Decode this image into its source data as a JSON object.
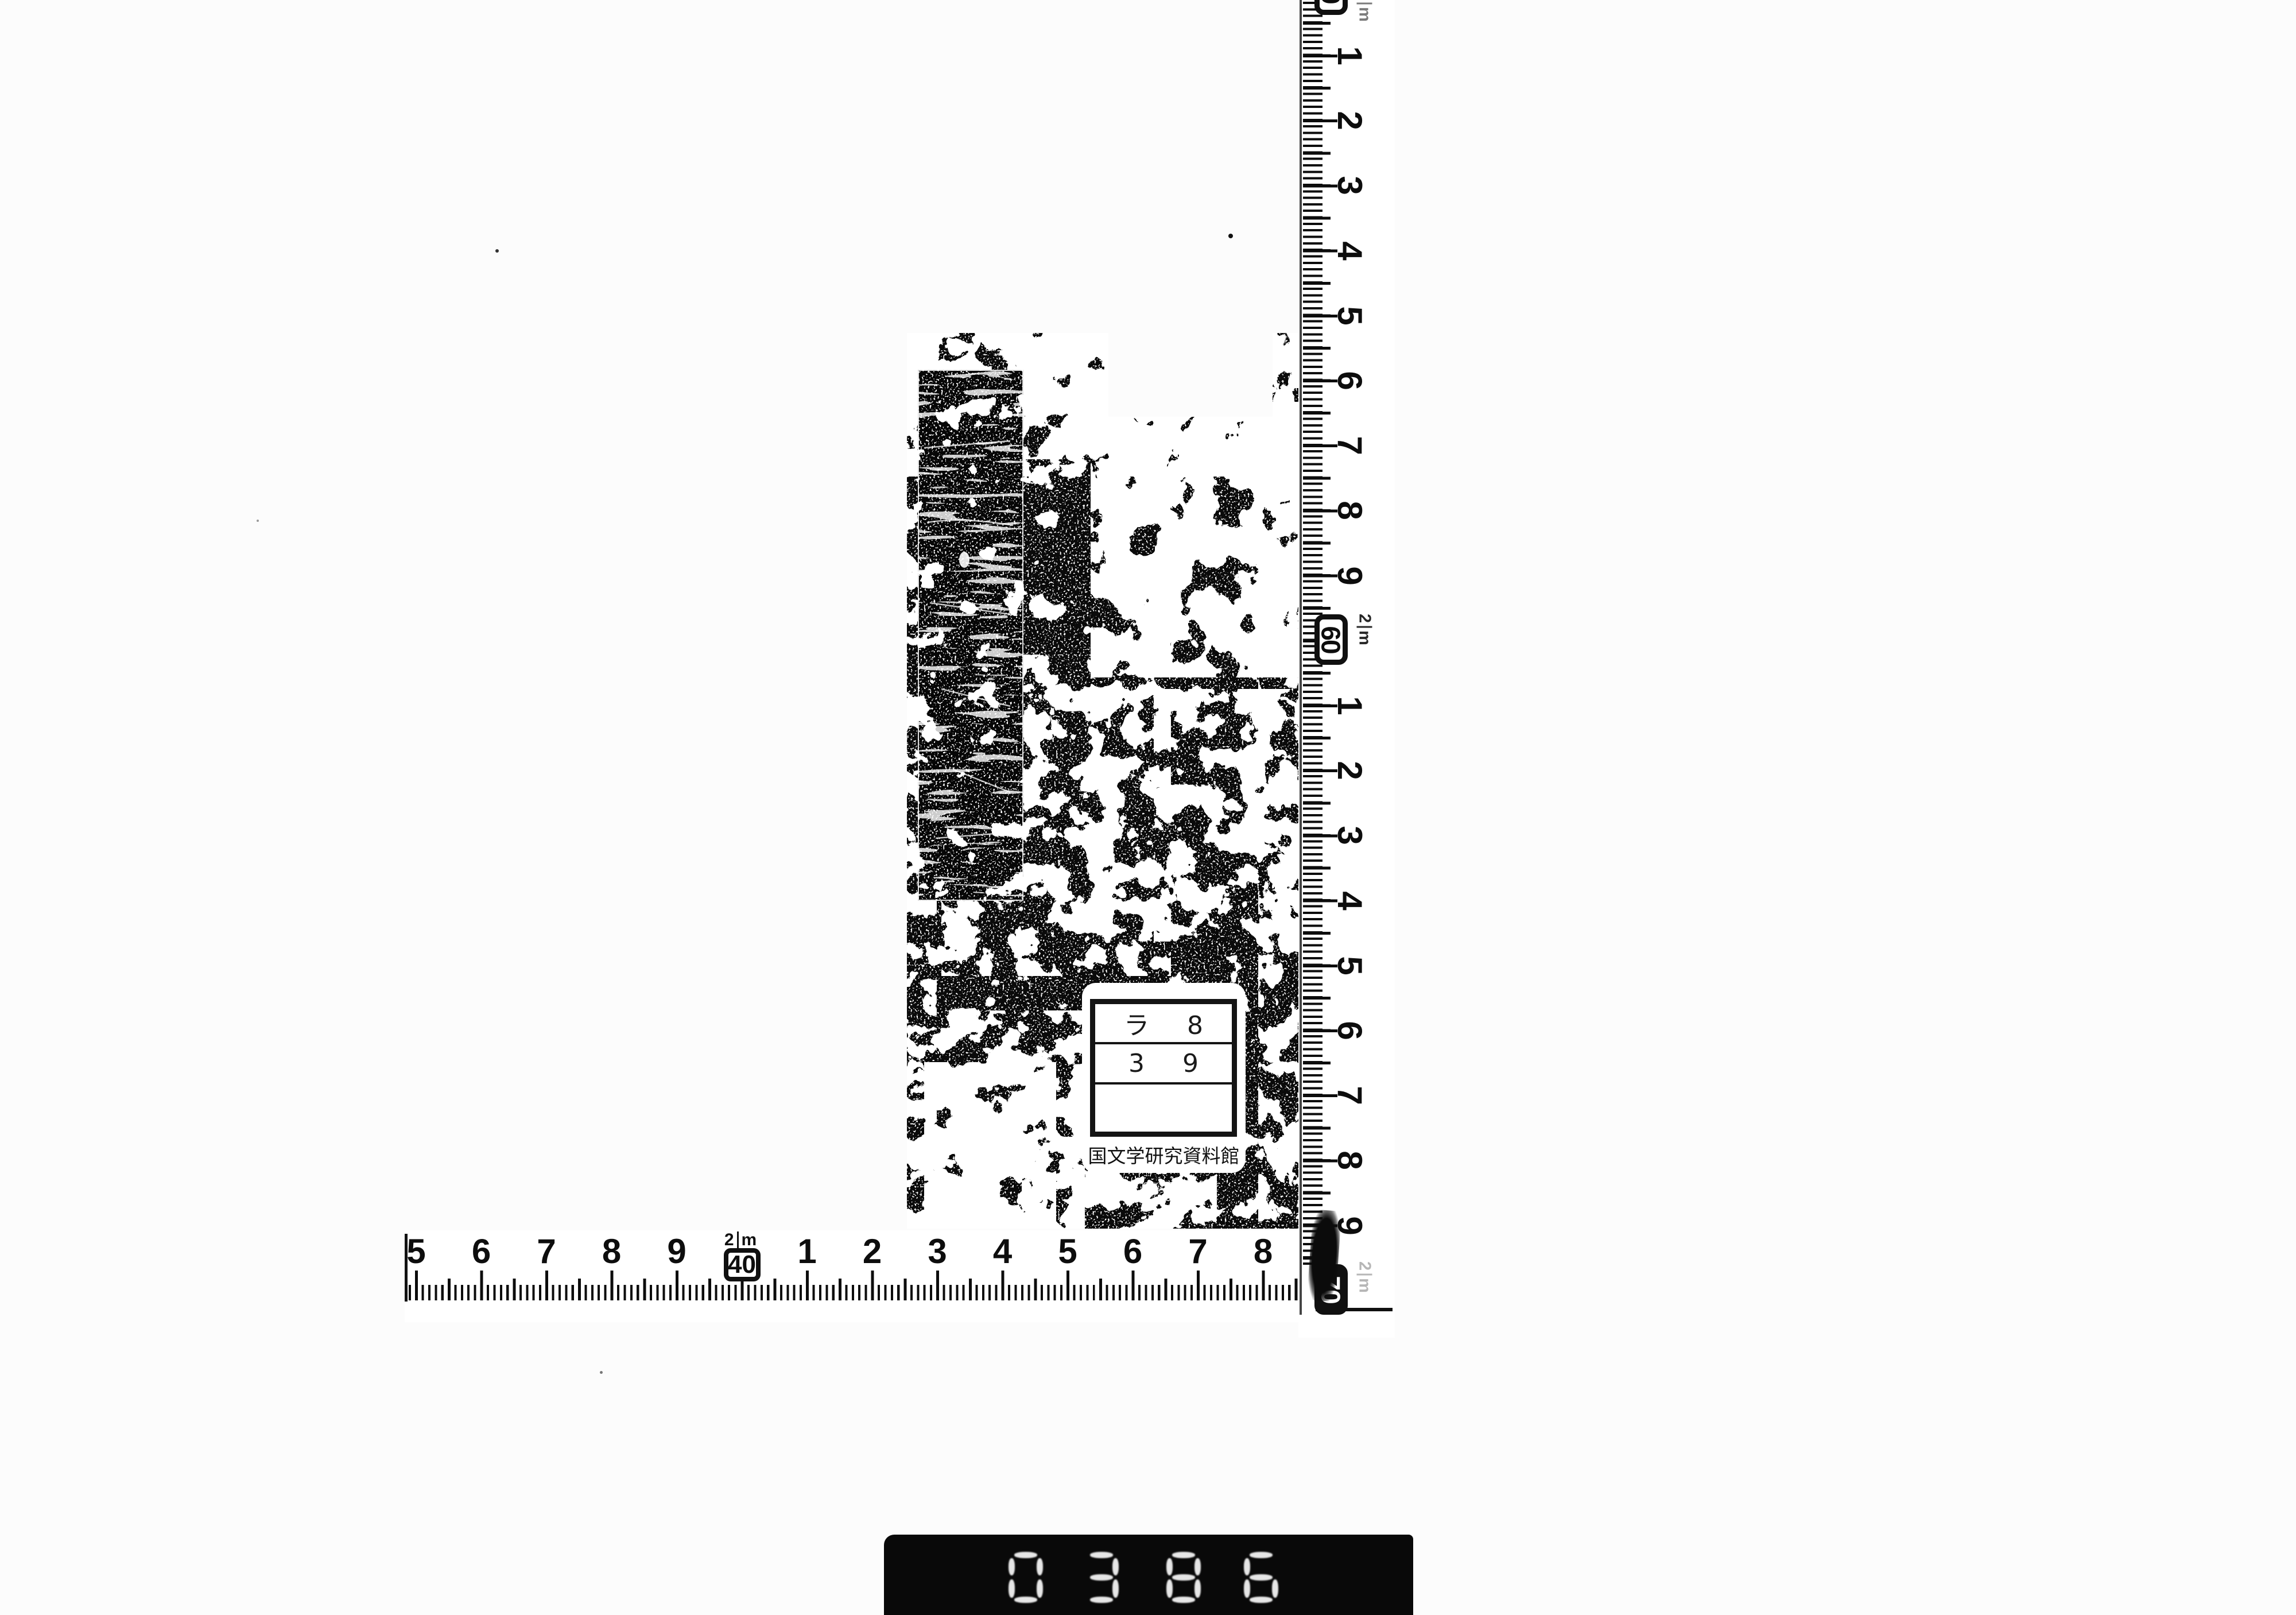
{
  "label": {
    "row1": "ラ 8",
    "row2": "3 9",
    "row3": "",
    "caption": "国文学研究資料館"
  },
  "rulers": {
    "vertical": {
      "top_box": "50",
      "upper": [
        "1",
        "2",
        "3",
        "4",
        "5",
        "6",
        "7",
        "8",
        "9"
      ],
      "mid_box": "60",
      "lower": [
        "1",
        "2",
        "3",
        "4",
        "5",
        "6",
        "7",
        "8",
        "9"
      ],
      "bottom_box": "70",
      "unit_value": "2",
      "unit_symbol": "m"
    },
    "horizontal": {
      "left_numbers": [
        "5",
        "6",
        "7",
        "8",
        "9"
      ],
      "box": "40",
      "right_numbers": [
        "1",
        "2",
        "3",
        "4",
        "5",
        "6",
        "7",
        "8"
      ],
      "unit_value": "2",
      "unit_symbol": "m"
    }
  },
  "counter": {
    "digits": [
      {
        "approx": "0",
        "segments": [
          "t",
          "tl",
          "tr",
          "bl",
          "br",
          "b"
        ]
      },
      {
        "approx": "3",
        "segments": [
          "t",
          "tr",
          "m",
          "br",
          "b"
        ]
      },
      {
        "approx": "8",
        "segments": [
          "t",
          "tl",
          "tr",
          "m",
          "bl",
          "br",
          "b"
        ]
      },
      {
        "approx": "6",
        "segments": [
          "t",
          "tl",
          "m",
          "bl",
          "br",
          "b"
        ]
      }
    ]
  },
  "colors": {
    "ink": "#0c0c0c",
    "paper": "#fcfcfc",
    "cover": "#0a0a0a"
  }
}
